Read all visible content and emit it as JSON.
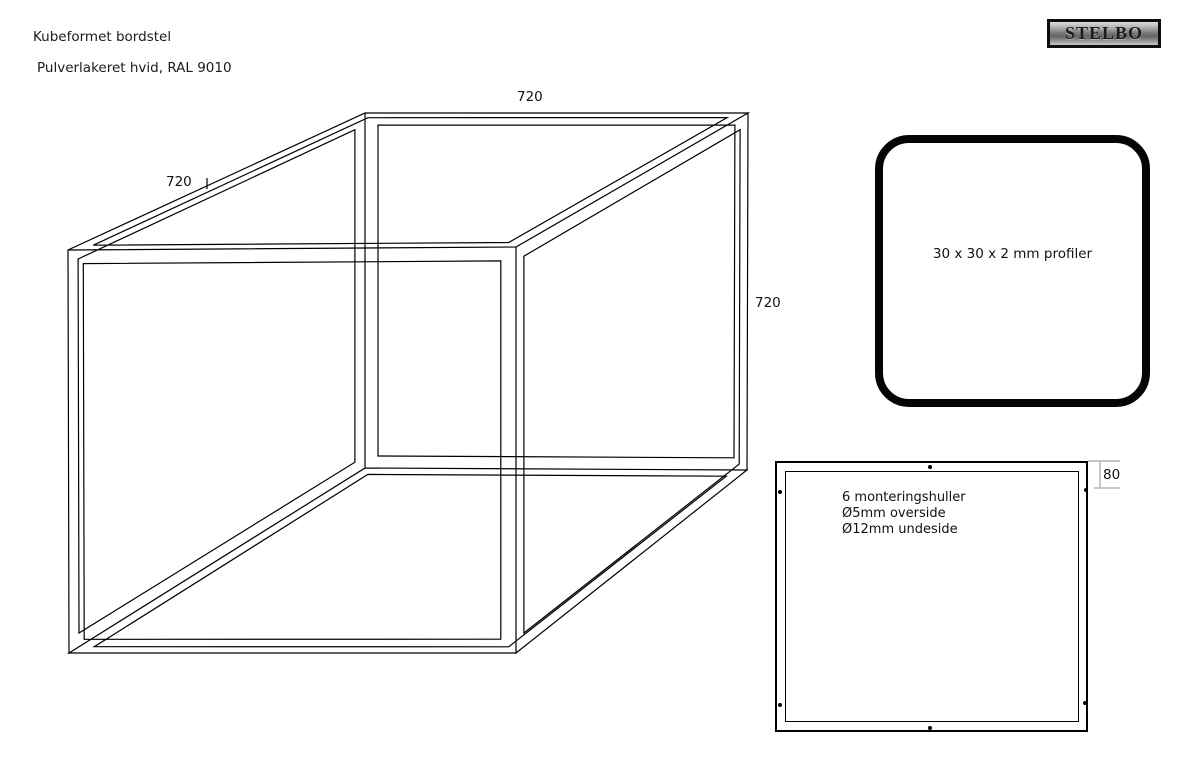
{
  "header": {
    "title": "Kubeformet bordstel",
    "subtitle": "Pulverlakeret hvid, RAL 9010"
  },
  "logo": {
    "text": "STELBO"
  },
  "cube": {
    "dim_top": "720",
    "dim_left": "720",
    "dim_right": "720"
  },
  "profile": {
    "label": "30 x 30 x 2 mm profiler"
  },
  "plate": {
    "notes": [
      "6 monteringshuller",
      "Ø5mm overside",
      "Ø12mm undeside"
    ],
    "dim_offset": "80"
  },
  "colors": {
    "line": "#000000",
    "dimension_line": "#b4b4b4",
    "background": "#ffffff"
  }
}
